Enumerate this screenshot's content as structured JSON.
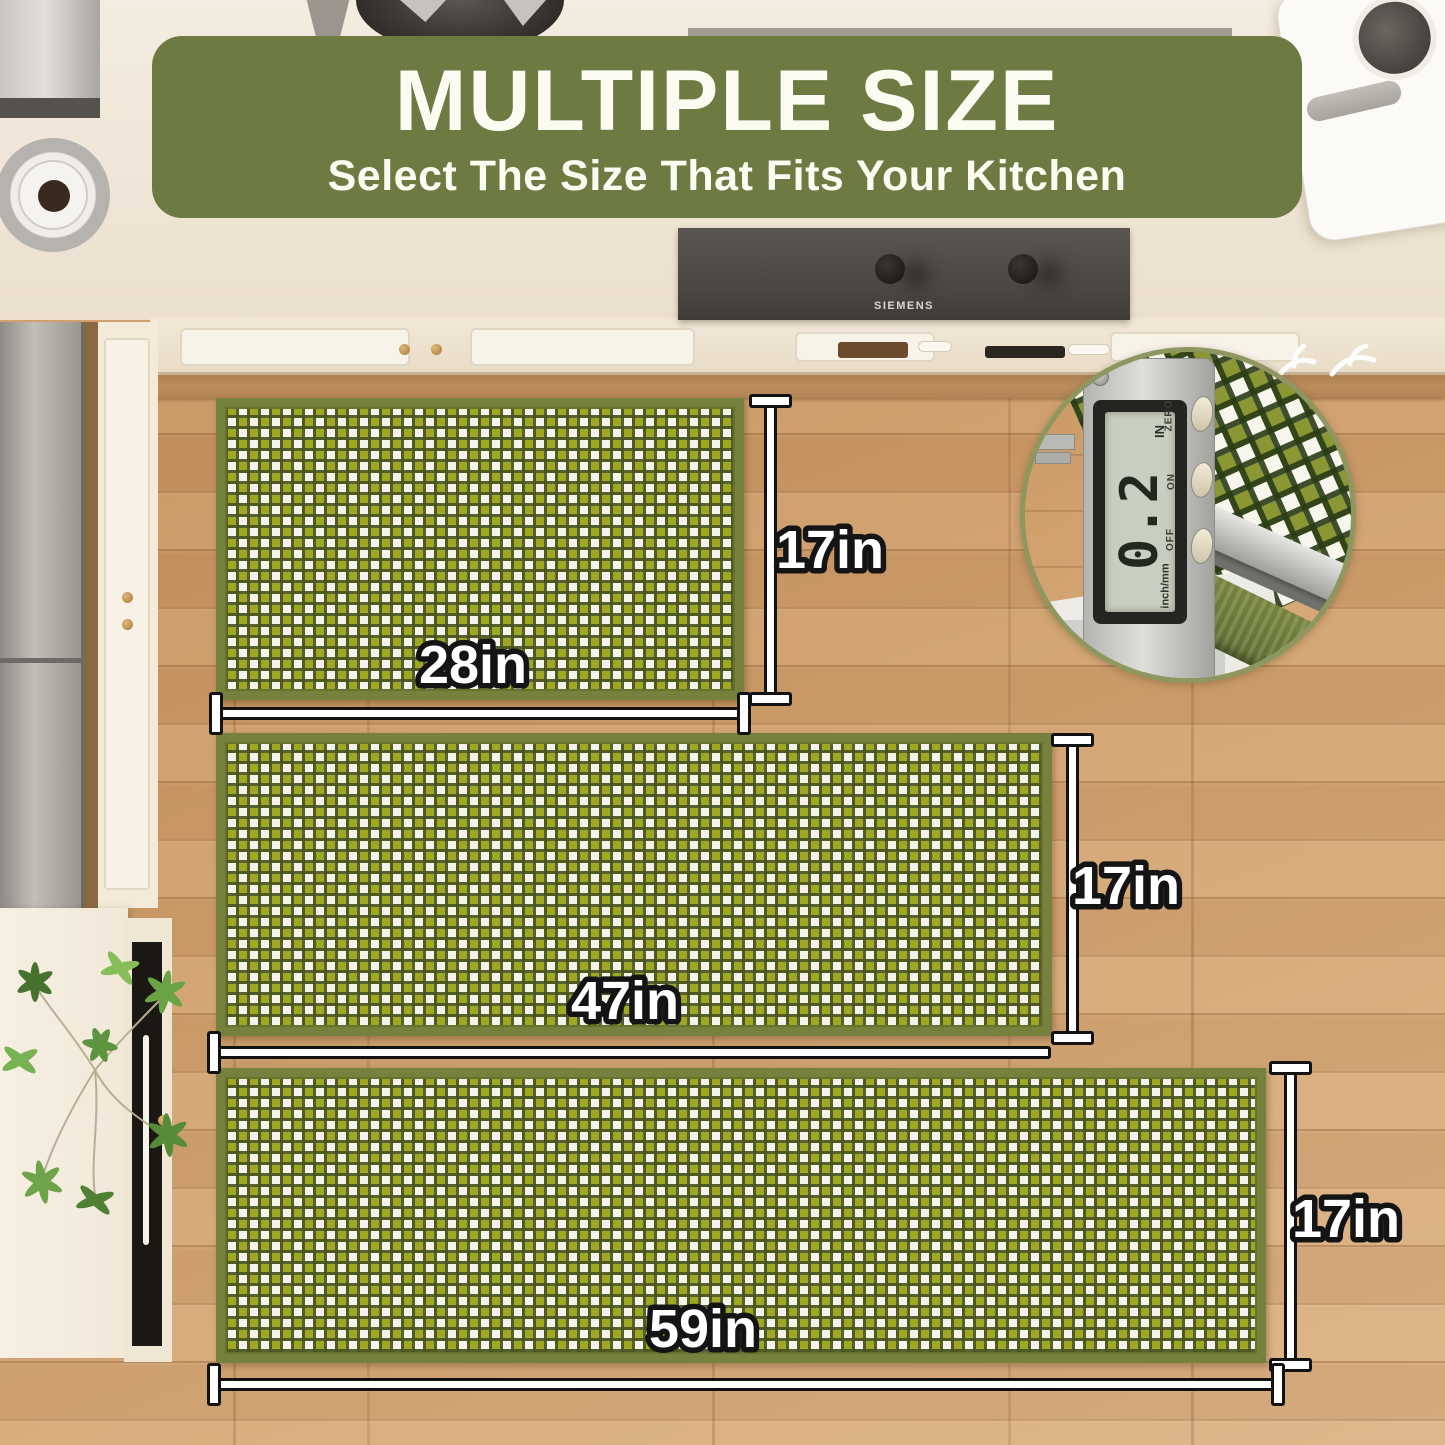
{
  "banner": {
    "title": "MULTIPLE SIZE",
    "subtitle": "Select The Size That Fits Your Kitchen",
    "background": "#6d7a42",
    "text_color": "#fcfbf2"
  },
  "mats": [
    {
      "name": "small runner",
      "width_label": "28in",
      "height_label": "17in"
    },
    {
      "name": "medium runner",
      "width_label": "47in",
      "height_label": "17in"
    },
    {
      "name": "large runner",
      "width_label": "59in",
      "height_label": "17in"
    }
  ],
  "hood": {
    "brand": "SIEMENS"
  },
  "caliper": {
    "reading": "0.2",
    "unit": "IN",
    "side_labels": [
      "ZERO",
      "ON",
      "OFF"
    ],
    "mode_label": "inch/mm"
  },
  "colors": {
    "banner_green": "#6d7a42",
    "mat_green": "#9fa822",
    "mat_white": "#f4f3ea",
    "mat_border": "#76813e",
    "floor_wood": "#cd9c69",
    "counter_cream": "#f1e8da",
    "hood_gray": "#4a4541",
    "dimension_line": "#ffffff"
  }
}
